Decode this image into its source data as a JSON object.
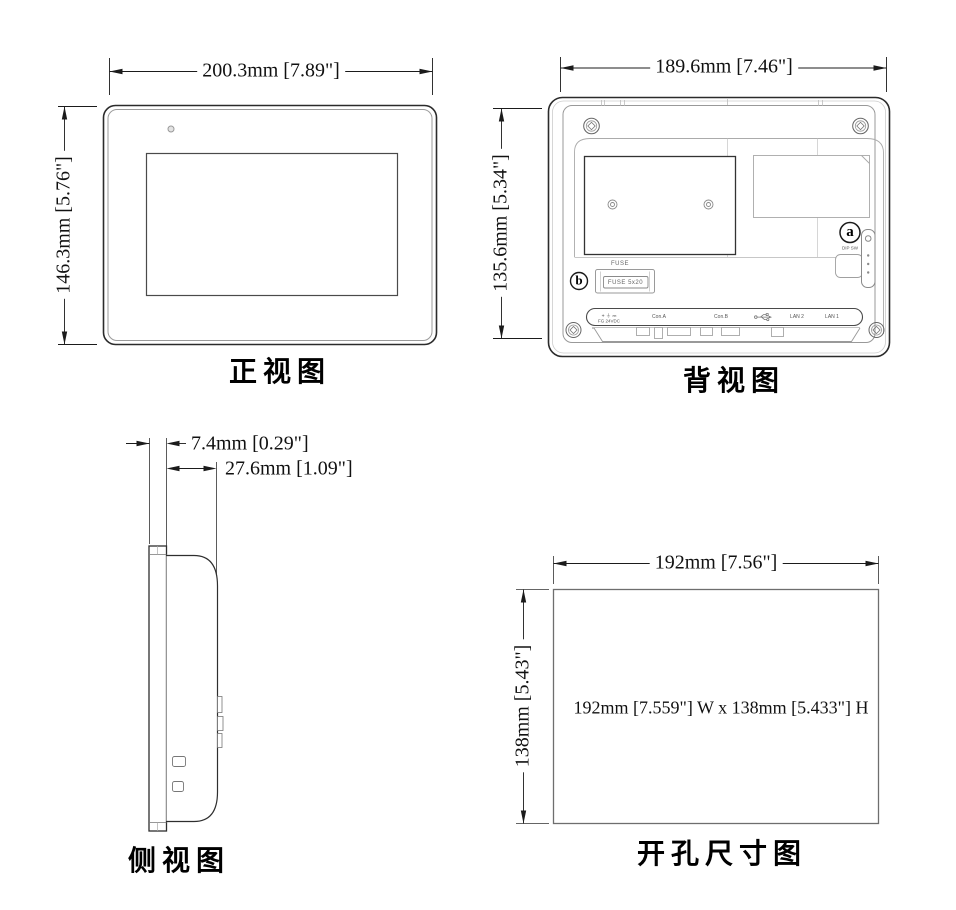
{
  "page": {
    "background": "#ffffff",
    "line_color": "#1b1b1b"
  },
  "views": {
    "front": {
      "caption": "正视图",
      "dim_width": "200.3mm [7.89\"]",
      "dim_height": "146.3mm [5.76\"]"
    },
    "back": {
      "caption": "背视图",
      "dim_width": "189.6mm [7.46\"]",
      "dim_height": "135.6mm [5.34\"]",
      "callout_a": "a",
      "callout_b": "b",
      "dip_sw_label": "DIP SW",
      "fuse_label": "FUSE",
      "fuse_value": "FUSE 5x20",
      "ports": {
        "power_line1": "+ ⏚ ⎓",
        "power_line2": "FG  24VDC",
        "con_a": "Con.A",
        "con_b": "Con.B",
        "lan2": "LAN 2",
        "lan1": "LAN 1"
      }
    },
    "side": {
      "caption": "侧视图",
      "dim_bezel": "7.4mm [0.29\"]",
      "dim_depth": "27.6mm [1.09\"]"
    },
    "cutout": {
      "caption": "开孔尺寸图",
      "dim_width": "192mm [7.56\"]",
      "dim_height": "138mm [5.43\"]",
      "center_note": "192mm [7.559\"] W x 138mm [5.433\"] H"
    }
  }
}
